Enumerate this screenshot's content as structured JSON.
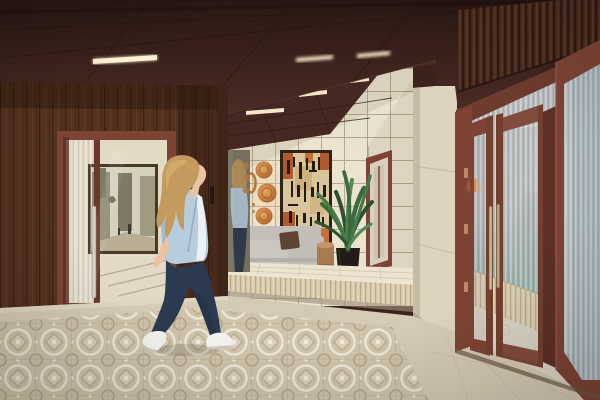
{
  "scene": {
    "type": "architectural-interior-render",
    "setting": "residential lobby / entrance hall",
    "description": "Photorealistic render of a lobby with dark walnut wall panelling, oxblood steel-framed glass doors, a recessed lounge niche with cream square tiles, abstract terracotta artwork, copper disc sconces, a grey modular bench, a wooden stool and an areca palm. A blonde woman in a light-blue blouse, navy jeans and white sneakers walks right across a patterned encaustic tile floor, reflected in a tall mirror. At right, reeded-glass entrance doors stand open toward a daylit vestibule.",
    "objects": [
      "panelled-ceiling",
      "linear-ceiling-lights",
      "perforated-vent-strip",
      "walnut-wall-panelling",
      "left-glass-door",
      "framed-street-painting",
      "tall-mirror",
      "woman-walking",
      "mirror-reflection",
      "lounge-niche-tiled-wall",
      "abstract-artwork",
      "copper-disc-sconces",
      "grey-bench",
      "brown-cushion",
      "areca-palm",
      "black-planter",
      "wood-stool",
      "niche-end-door",
      "raised-platform",
      "stone-pillar",
      "entrance-double-doors",
      "door-handles",
      "door-hinges",
      "access-reader",
      "reeded-glass-facade",
      "vestibule",
      "wainscot",
      "patterned-tile-floor",
      "plain-tile-floor",
      "wood-slat-clerestory",
      "open-door-leaf"
    ]
  },
  "colors": {
    "ceiling": "#35201b",
    "ceiling_lower": "#4c2c24",
    "corridor_ceiling": "#4a2a23",
    "wood": "#54321f",
    "wood_dark": "#3f2517",
    "frame": "#7d4435",
    "frame_dark": "#5d3026",
    "tile": "#eae2d0",
    "grout": "#a79a81",
    "stone": "#ded3bd",
    "floor_base": "#d5cab4",
    "floor_tile": "#cfc3ab",
    "platform": "#d7caac",
    "alcove_floor": "#ece4d1",
    "bench": "#cac7c1",
    "bench_back": "#c2bfb9",
    "pillow": "#5d4434",
    "plant": "#3c6a3e",
    "planter": "#211c16",
    "copper": "#c27a3e",
    "art_frame": "#2c2217",
    "art_bg": "#d9c59c",
    "art_rust": "#b05a2e",
    "art_mark": "#241c12",
    "glass_top": "#b4b9be",
    "glass_teal": "#8db4aa",
    "wainscot": "#d8cbae",
    "vestibule_floor": "#ddd6c6",
    "light_bar": "#f5e7c6",
    "reader_glow": "#ff9440",
    "hair": "#c49a5e",
    "skin": "#e9c3a4",
    "blouse": "#b6cddd",
    "inner_shirt": "#eef1f4",
    "jeans": "#2b3a4f",
    "sneaker": "#f2f2f0",
    "handle_metal": "#c7b197",
    "painting_sky": "#d6d0be"
  }
}
